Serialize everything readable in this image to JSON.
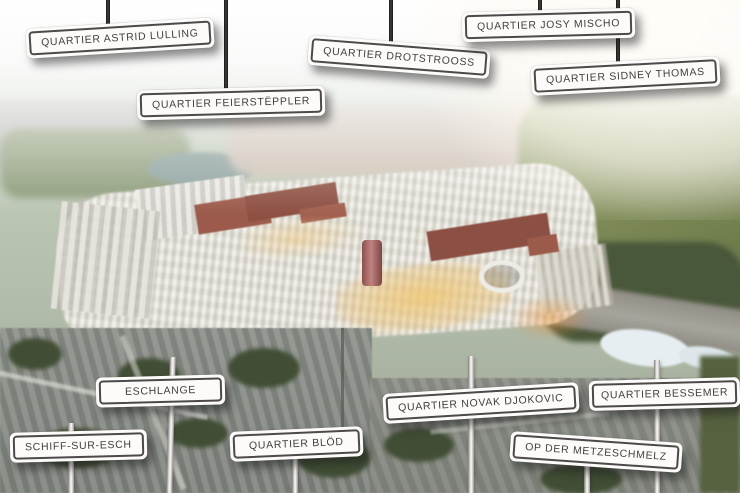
{
  "scene": {
    "name": "Aerial masterplan rendering with district signposts",
    "colors": {
      "sign_background": "#fcfbf9",
      "sign_border": "#4b4a48",
      "sign_text": "#403f3d",
      "pole_dark": "#2c2a28",
      "pole_light": "#e8e6e2",
      "red_tower": "#a2605d",
      "amber_plaza": "#eec878",
      "forest": "#49573a"
    }
  },
  "signs": [
    {
      "id": "quartier-astrid-lulling",
      "label": "QUARTIER ASTRID LULLING",
      "position": "top"
    },
    {
      "id": "quartier-feiersteppler",
      "label": "QUARTIER FEIERSTËPPLER",
      "position": "top"
    },
    {
      "id": "quartier-drotstrooss",
      "label": "QUARTIER DROTSTROOSS",
      "position": "top"
    },
    {
      "id": "quartier-josy-mischo",
      "label": "QUARTIER JOSY MISCHO",
      "position": "top"
    },
    {
      "id": "quartier-sidney-thomas",
      "label": "QUARTIER SIDNEY THOMAS",
      "position": "top"
    },
    {
      "id": "eschlange",
      "label": "ESCHLANGE",
      "position": "bottom"
    },
    {
      "id": "schiff-sur-esch",
      "label": "SCHIFF-SUR-ESCH",
      "position": "bottom"
    },
    {
      "id": "quartier-blod",
      "label": "QUARTIER BLÖD",
      "position": "bottom"
    },
    {
      "id": "quartier-novak-djokovic",
      "label": "QUARTIER NOVAK DJOKOVIC",
      "position": "bottom"
    },
    {
      "id": "op-der-metzeschmelz",
      "label": "OP DER METZESCHMELZ",
      "position": "bottom"
    },
    {
      "id": "quartier-bessemer",
      "label": "QUARTIER BESSEMER",
      "position": "bottom"
    }
  ]
}
